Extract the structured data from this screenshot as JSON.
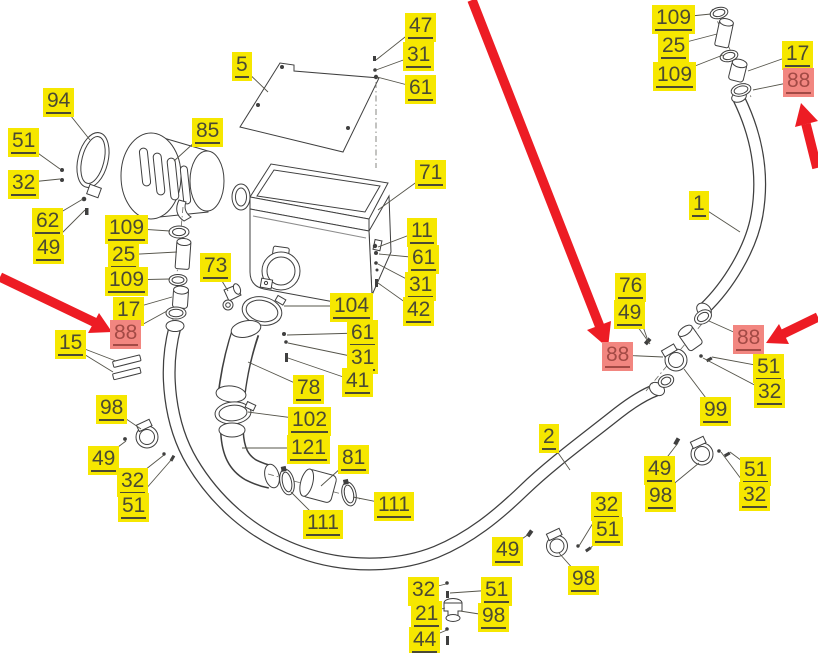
{
  "title": "Air intake system exploded parts diagram",
  "colors": {
    "label_bg": "#f6e700",
    "label_text": "#4b4a33",
    "label_hl_bg": "#f28680",
    "label_hl_text": "#a34a45",
    "line": "#3f3f3f",
    "leader": "#55544a",
    "arrow": "#ed1c24",
    "background": "#ffffff"
  },
  "labels": [
    {
      "t": "94",
      "x": 43,
      "y": 88
    },
    {
      "t": "51",
      "x": 8,
      "y": 128
    },
    {
      "t": "32",
      "x": 8,
      "y": 170
    },
    {
      "t": "62",
      "x": 32,
      "y": 208
    },
    {
      "t": "49",
      "x": 33,
      "y": 235
    },
    {
      "t": "109",
      "x": 105,
      "y": 215
    },
    {
      "t": "25",
      "x": 108,
      "y": 242
    },
    {
      "t": "109",
      "x": 105,
      "y": 267
    },
    {
      "t": "17",
      "x": 113,
      "y": 297
    },
    {
      "t": "88",
      "x": 110,
      "y": 320,
      "hl": true
    },
    {
      "t": "15",
      "x": 55,
      "y": 330
    },
    {
      "t": "5",
      "x": 232,
      "y": 52
    },
    {
      "t": "85",
      "x": 192,
      "y": 118
    },
    {
      "t": "47",
      "x": 405,
      "y": 13
    },
    {
      "t": "31",
      "x": 403,
      "y": 42
    },
    {
      "t": "61",
      "x": 405,
      "y": 75
    },
    {
      "t": "71",
      "x": 415,
      "y": 160
    },
    {
      "t": "11",
      "x": 407,
      "y": 218
    },
    {
      "t": "61",
      "x": 408,
      "y": 245
    },
    {
      "t": "31",
      "x": 405,
      "y": 272
    },
    {
      "t": "42",
      "x": 403,
      "y": 297
    },
    {
      "t": "73",
      "x": 200,
      "y": 253
    },
    {
      "t": "104",
      "x": 330,
      "y": 293
    },
    {
      "t": "61",
      "x": 347,
      "y": 320
    },
    {
      "t": "31",
      "x": 347,
      "y": 345
    },
    {
      "t": "41",
      "x": 342,
      "y": 368
    },
    {
      "t": "78",
      "x": 293,
      "y": 375
    },
    {
      "t": "102",
      "x": 288,
      "y": 407
    },
    {
      "t": "121",
      "x": 287,
      "y": 435
    },
    {
      "t": "81",
      "x": 338,
      "y": 445
    },
    {
      "t": "111",
      "x": 303,
      "y": 510
    },
    {
      "t": "111",
      "x": 374,
      "y": 492
    },
    {
      "t": "98",
      "x": 96,
      "y": 395
    },
    {
      "t": "49",
      "x": 88,
      "y": 446
    },
    {
      "t": "32",
      "x": 117,
      "y": 468
    },
    {
      "t": "51",
      "x": 118,
      "y": 493
    },
    {
      "t": "109",
      "x": 652,
      "y": 5
    },
    {
      "t": "25",
      "x": 658,
      "y": 33
    },
    {
      "t": "109",
      "x": 653,
      "y": 62
    },
    {
      "t": "17",
      "x": 782,
      "y": 41
    },
    {
      "t": "88",
      "x": 783,
      "y": 68,
      "hl": true
    },
    {
      "t": "1",
      "x": 689,
      "y": 191
    },
    {
      "t": "76",
      "x": 615,
      "y": 273
    },
    {
      "t": "49",
      "x": 614,
      "y": 300
    },
    {
      "t": "88",
      "x": 602,
      "y": 342,
      "hl": true
    },
    {
      "t": "88",
      "x": 733,
      "y": 325,
      "hl": true
    },
    {
      "t": "51",
      "x": 753,
      "y": 354
    },
    {
      "t": "32",
      "x": 754,
      "y": 379
    },
    {
      "t": "99",
      "x": 700,
      "y": 397
    },
    {
      "t": "2",
      "x": 539,
      "y": 424
    },
    {
      "t": "49",
      "x": 644,
      "y": 456
    },
    {
      "t": "98",
      "x": 645,
      "y": 483
    },
    {
      "t": "51",
      "x": 740,
      "y": 457
    },
    {
      "t": "32",
      "x": 739,
      "y": 482
    },
    {
      "t": "49",
      "x": 492,
      "y": 537
    },
    {
      "t": "32",
      "x": 591,
      "y": 492
    },
    {
      "t": "51",
      "x": 592,
      "y": 517
    },
    {
      "t": "98",
      "x": 568,
      "y": 566
    },
    {
      "t": "32",
      "x": 408,
      "y": 577
    },
    {
      "t": "21",
      "x": 411,
      "y": 601
    },
    {
      "t": "44",
      "x": 409,
      "y": 627
    },
    {
      "t": "51",
      "x": 481,
      "y": 577
    },
    {
      "t": "98",
      "x": 478,
      "y": 603
    }
  ],
  "leaders": [
    [
      59,
      101,
      90,
      140
    ],
    [
      21,
      141,
      60,
      169
    ],
    [
      21,
      183,
      60,
      179
    ],
    [
      46,
      221,
      83,
      199
    ],
    [
      47,
      248,
      85,
      210
    ],
    [
      124,
      228,
      170,
      231
    ],
    [
      122,
      255,
      177,
      252
    ],
    [
      124,
      280,
      170,
      279
    ],
    [
      127,
      310,
      172,
      297
    ],
    [
      127,
      333,
      167,
      311
    ],
    [
      69,
      343,
      116,
      361
    ],
    [
      69,
      345,
      113,
      372
    ],
    [
      240,
      65,
      268,
      92
    ],
    [
      207,
      131,
      174,
      161
    ],
    [
      419,
      26,
      376,
      60
    ],
    [
      417,
      55,
      376,
      70
    ],
    [
      419,
      88,
      377,
      77
    ],
    [
      429,
      173,
      378,
      210
    ],
    [
      420,
      231,
      378,
      247
    ],
    [
      421,
      258,
      379,
      254
    ],
    [
      418,
      285,
      378,
      264
    ],
    [
      416,
      310,
      378,
      283
    ],
    [
      213,
      266,
      228,
      291
    ],
    [
      351,
      306,
      284,
      306
    ],
    [
      360,
      333,
      287,
      335
    ],
    [
      360,
      358,
      288,
      343
    ],
    [
      355,
      381,
      288,
      358
    ],
    [
      306,
      388,
      248,
      362
    ],
    [
      309,
      420,
      248,
      412
    ],
    [
      308,
      448,
      242,
      448
    ],
    [
      352,
      458,
      321,
      486
    ],
    [
      322,
      523,
      291,
      492
    ],
    [
      393,
      505,
      353,
      497
    ],
    [
      110,
      408,
      141,
      429
    ],
    [
      102,
      459,
      126,
      441
    ],
    [
      131,
      481,
      164,
      455
    ],
    [
      131,
      506,
      172,
      459
    ],
    [
      671,
      18,
      711,
      14
    ],
    [
      671,
      46,
      717,
      34
    ],
    [
      672,
      75,
      723,
      55
    ],
    [
      796,
      54,
      748,
      71
    ],
    [
      797,
      81,
      753,
      90
    ],
    [
      697,
      204,
      740,
      232
    ],
    [
      629,
      286,
      647,
      338
    ],
    [
      628,
      313,
      650,
      344
    ],
    [
      618,
      355,
      663,
      357
    ],
    [
      747,
      338,
      709,
      321
    ],
    [
      766,
      367,
      712,
      357
    ],
    [
      768,
      392,
      703,
      358
    ],
    [
      715,
      410,
      684,
      369
    ],
    [
      547,
      437,
      570,
      470
    ],
    [
      658,
      469,
      678,
      443
    ],
    [
      659,
      496,
      699,
      463
    ],
    [
      754,
      470,
      730,
      452
    ],
    [
      753,
      495,
      721,
      452
    ],
    [
      506,
      550,
      529,
      534
    ],
    [
      604,
      505,
      579,
      546
    ],
    [
      606,
      530,
      589,
      550
    ],
    [
      582,
      579,
      559,
      553
    ],
    [
      422,
      590,
      446,
      584
    ],
    [
      424,
      614,
      445,
      608
    ],
    [
      423,
      640,
      447,
      630
    ],
    [
      494,
      590,
      450,
      593
    ],
    [
      492,
      616,
      460,
      611
    ]
  ],
  "arrows": [
    {
      "line": [
        0,
        277,
        96,
        323
      ],
      "head": [
        112,
        332,
        88,
        333,
        99,
        313
      ]
    },
    {
      "line": [
        472,
        0,
        600,
        327
      ],
      "head": [
        608,
        348,
        587,
        330,
        611,
        321
      ]
    },
    {
      "line": [
        818,
        317,
        783,
        334
      ],
      "head": [
        766,
        343,
        779,
        324,
        789,
        344
      ]
    },
    {
      "line": [
        817,
        168,
        806,
        124
      ],
      "head": [
        801,
        103,
        818,
        121,
        795,
        127
      ]
    }
  ]
}
